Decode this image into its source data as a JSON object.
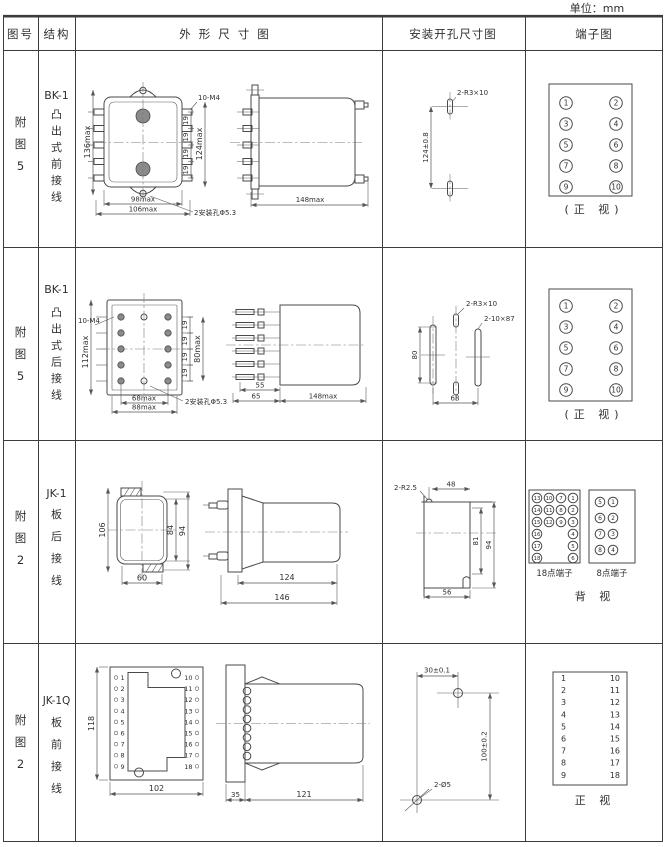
{
  "unit_label": "单位：mm",
  "header": {
    "col_fig": "图号",
    "col_structure": "结构",
    "col_outline": "外形尺寸图",
    "col_install": "安装开孔尺寸图",
    "col_terminal": "端子图"
  },
  "rows": [
    {
      "fig_chars": [
        "附",
        "图",
        "5"
      ],
      "model": "BK-1",
      "struct_chars": [
        "凸",
        "出",
        "式",
        "前",
        "接",
        "线"
      ],
      "outline": {
        "height": "136max",
        "height_inner": "124max",
        "pitch": "19",
        "thread": "10-M4",
        "width": "98max",
        "width_outer": "106max",
        "holes_note": "2安装孔Φ5.3",
        "depth": "148max"
      },
      "install": {
        "slot_note": "2-R3×10",
        "pitch_v": "124±0.8"
      },
      "terminal": {
        "left": [
          "1",
          "3",
          "5",
          "7",
          "9"
        ],
        "right": [
          "2",
          "4",
          "6",
          "8",
          "10"
        ],
        "caption": "(正 视)"
      }
    },
    {
      "fig_chars": [
        "附",
        "图",
        "5"
      ],
      "model": "BK-1",
      "struct_chars": [
        "凸",
        "出",
        "式",
        "后",
        "接",
        "线"
      ],
      "outline": {
        "height": "112max",
        "thread": "10-M4",
        "pitch": "19",
        "height_inner": "80max",
        "width": "68max",
        "width_outer": "88max",
        "holes_note": "2安装孔Φ5.3",
        "stud_a": "55",
        "stud_b": "65",
        "depth": "148max"
      },
      "install": {
        "slot_note": "2-R3×10",
        "slot_note2": "2-10×87",
        "height": "80",
        "width": "68"
      },
      "terminal": {
        "left": [
          "1",
          "3",
          "5",
          "7",
          "9"
        ],
        "right": [
          "2",
          "4",
          "6",
          "8",
          "10"
        ],
        "caption": "(正 视)"
      }
    },
    {
      "fig_chars": [
        "附",
        "图",
        "2"
      ],
      "model": "JK-1",
      "struct_chars": [
        "板",
        "后",
        "接",
        "线"
      ],
      "outline": {
        "height": "106",
        "height_inner": "84",
        "height_outer": "94",
        "width": "60",
        "depth": "124",
        "depth_outer": "146"
      },
      "install": {
        "corner_note": "2-R2.5",
        "width": "48",
        "height_inner": "81",
        "height_outer": "94",
        "width_bottom": "56"
      },
      "terminal": {
        "t18_cols": [
          [
            "13",
            "14",
            "15",
            "16",
            "17",
            "18"
          ],
          [
            "10",
            "11",
            "12"
          ],
          [
            "7",
            "8",
            "9"
          ],
          [
            "1",
            "2",
            "3",
            "4",
            "5",
            "6"
          ]
        ],
        "t18_label": "18点端子",
        "t8_cols": [
          [
            "5",
            "6",
            "7",
            "8"
          ],
          [
            "1",
            "2",
            "3",
            "4"
          ]
        ],
        "t8_label": "8点端子",
        "caption": "背 视"
      }
    },
    {
      "fig_chars": [
        "附",
        "图",
        "2"
      ],
      "model": "JK-1Q",
      "struct_chars": [
        "板",
        "前",
        "接",
        "线"
      ],
      "outline": {
        "height": "118",
        "width": "102",
        "pins_left": [
          "1",
          "2",
          "3",
          "4",
          "5",
          "6",
          "7",
          "8",
          "9"
        ],
        "pins_right": [
          "10",
          "11",
          "12",
          "13",
          "14",
          "15",
          "16",
          "17",
          "18"
        ],
        "depth_a": "35",
        "depth_b": "121"
      },
      "install": {
        "width": "30±0.1",
        "height": "100±0.2",
        "holes_note": "2-Ø5"
      },
      "terminal": {
        "left": [
          "1",
          "2",
          "3",
          "4",
          "5",
          "6",
          "7",
          "8",
          "9"
        ],
        "right": [
          "10",
          "11",
          "12",
          "13",
          "14",
          "15",
          "16",
          "17",
          "18"
        ],
        "caption": "正 视"
      }
    }
  ],
  "colors": {
    "line": "#4a4a4a",
    "grid": "#3c3c3c",
    "text": "#2f2f2f",
    "background": "#ffffff"
  }
}
